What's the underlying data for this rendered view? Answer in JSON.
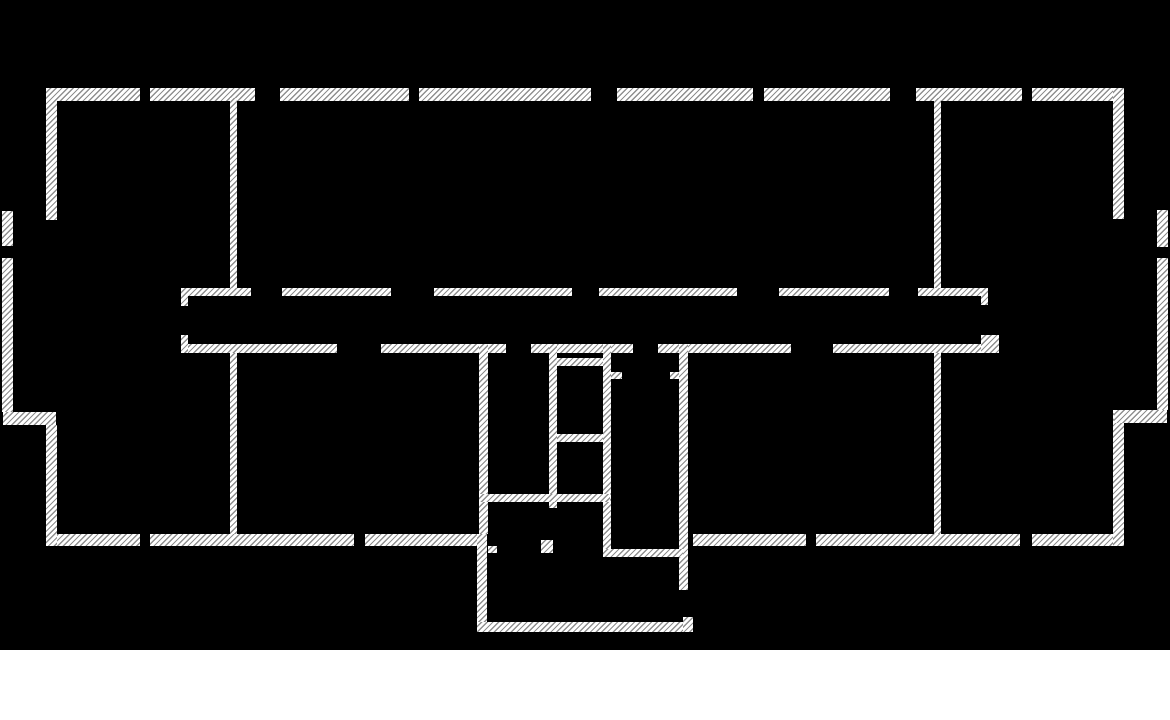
{
  "page": {
    "type": "architectural-floor-plan",
    "canvas_width": 1170,
    "canvas_height": 650,
    "total_height": 720
  },
  "colors": {
    "background": "#000000",
    "page_background": "#ffffff",
    "wall_fill": "#ffffff",
    "hatch_line": "#8f8f8f",
    "hatch_spacing_px": 4,
    "hatch_line_px": 1.3,
    "hatch_direction_deg": 135
  },
  "floor_plan": {
    "walls": [
      {
        "id": "top-wall-segment-1",
        "x": 46,
        "y": 88,
        "w": 94,
        "h": 13
      },
      {
        "id": "top-wall-segment-2",
        "x": 150,
        "y": 88,
        "w": 105,
        "h": 13
      },
      {
        "id": "top-wall-segment-3",
        "x": 280,
        "y": 88,
        "w": 129,
        "h": 13
      },
      {
        "id": "top-wall-segment-4",
        "x": 419,
        "y": 88,
        "w": 172,
        "h": 13
      },
      {
        "id": "top-wall-segment-5",
        "x": 617,
        "y": 88,
        "w": 136,
        "h": 13
      },
      {
        "id": "top-wall-segment-6",
        "x": 764,
        "y": 88,
        "w": 126,
        "h": 13
      },
      {
        "id": "top-wall-segment-7",
        "x": 916,
        "y": 88,
        "w": 106,
        "h": 13
      },
      {
        "id": "top-wall-segment-8",
        "x": 1032,
        "y": 88,
        "w": 92,
        "h": 13
      },
      {
        "id": "bottom-wall-segment-1",
        "x": 48,
        "y": 534,
        "w": 92,
        "h": 12
      },
      {
        "id": "bottom-wall-segment-2",
        "x": 150,
        "y": 534,
        "w": 204,
        "h": 12
      },
      {
        "id": "bottom-wall-segment-3",
        "x": 365,
        "y": 534,
        "w": 117,
        "h": 12
      },
      {
        "id": "bottom-wall-segment-4",
        "x": 693,
        "y": 534,
        "w": 113,
        "h": 12
      },
      {
        "id": "bottom-wall-segment-5",
        "x": 816,
        "y": 534,
        "w": 204,
        "h": 12
      },
      {
        "id": "bottom-wall-segment-6",
        "x": 1032,
        "y": 534,
        "w": 86,
        "h": 12
      },
      {
        "id": "left-wall-upper",
        "x": 46,
        "y": 88,
        "w": 11,
        "h": 132
      },
      {
        "id": "left-wall-lower",
        "x": 46,
        "y": 425,
        "w": 11,
        "h": 121
      },
      {
        "id": "right-wall-upper",
        "x": 1113,
        "y": 88,
        "w": 11,
        "h": 131
      },
      {
        "id": "right-wall-lower",
        "x": 1113,
        "y": 410,
        "w": 11,
        "h": 136
      },
      {
        "id": "left-bay-wall-upper",
        "x": 2,
        "y": 211,
        "w": 11,
        "h": 35
      },
      {
        "id": "left-bay-wall-lower",
        "x": 2,
        "y": 258,
        "w": 11,
        "h": 154
      },
      {
        "id": "left-bay-connector",
        "x": 3,
        "y": 412,
        "w": 53,
        "h": 13
      },
      {
        "id": "right-bay-wall-upper",
        "x": 1157,
        "y": 210,
        "w": 11,
        "h": 37
      },
      {
        "id": "right-bay-wall-lower",
        "x": 1157,
        "y": 258,
        "w": 11,
        "h": 152
      },
      {
        "id": "right-bay-connector",
        "x": 1114,
        "y": 410,
        "w": 53,
        "h": 13
      },
      {
        "id": "left-room-divider-upper",
        "x": 230,
        "y": 98,
        "w": 7,
        "h": 190
      },
      {
        "id": "left-room-divider-lower",
        "x": 230,
        "y": 353,
        "w": 7,
        "h": 181
      },
      {
        "id": "right-room-divider-upper",
        "x": 934,
        "y": 98,
        "w": 7,
        "h": 190
      },
      {
        "id": "right-room-divider-lower",
        "x": 934,
        "y": 353,
        "w": 7,
        "h": 181
      },
      {
        "id": "corridor-upper-wall-segment-1",
        "x": 181,
        "y": 288,
        "w": 70,
        "h": 8
      },
      {
        "id": "corridor-upper-wall-segment-2",
        "x": 282,
        "y": 288,
        "w": 109,
        "h": 8
      },
      {
        "id": "corridor-upper-wall-segment-3",
        "x": 434,
        "y": 288,
        "w": 138,
        "h": 8
      },
      {
        "id": "corridor-upper-wall-segment-4",
        "x": 599,
        "y": 288,
        "w": 138,
        "h": 8
      },
      {
        "id": "corridor-upper-wall-segment-5",
        "x": 779,
        "y": 288,
        "w": 110,
        "h": 8
      },
      {
        "id": "corridor-upper-wall-segment-6",
        "x": 918,
        "y": 288,
        "w": 68,
        "h": 8
      },
      {
        "id": "corridor-upper-west-end-stub",
        "x": 181,
        "y": 288,
        "w": 7,
        "h": 18
      },
      {
        "id": "corridor-upper-east-end-stub",
        "x": 981,
        "y": 288,
        "w": 7,
        "h": 17
      },
      {
        "id": "corridor-lower-wall-segment-1",
        "x": 181,
        "y": 344,
        "w": 156,
        "h": 9
      },
      {
        "id": "corridor-lower-wall-segment-2",
        "x": 381,
        "y": 344,
        "w": 125,
        "h": 9
      },
      {
        "id": "corridor-lower-wall-segment-3",
        "x": 531,
        "y": 344,
        "w": 102,
        "h": 9
      },
      {
        "id": "corridor-lower-wall-segment-4",
        "x": 658,
        "y": 344,
        "w": 133,
        "h": 9
      },
      {
        "id": "corridor-lower-wall-segment-5",
        "x": 833,
        "y": 344,
        "w": 153,
        "h": 9
      },
      {
        "id": "corridor-lower-west-end-stub",
        "x": 181,
        "y": 335,
        "w": 7,
        "h": 18
      },
      {
        "id": "corridor-lower-east-end-stub",
        "x": 981,
        "y": 335,
        "w": 18,
        "h": 18
      },
      {
        "id": "stair-block-west-wall",
        "x": 479,
        "y": 344,
        "w": 9,
        "h": 190
      },
      {
        "id": "stair-block-inner-wall-1",
        "x": 549,
        "y": 344,
        "w": 8,
        "h": 164
      },
      {
        "id": "stair-block-inner-wall-2",
        "x": 603,
        "y": 344,
        "w": 8,
        "h": 213
      },
      {
        "id": "stair-block-east-wall",
        "x": 679,
        "y": 344,
        "w": 9,
        "h": 246
      },
      {
        "id": "stair-landing-wall-upper",
        "x": 557,
        "y": 358,
        "w": 46,
        "h": 8
      },
      {
        "id": "stair-landing-wall-lower",
        "x": 557,
        "y": 434,
        "w": 46,
        "h": 8
      },
      {
        "id": "stair-door-jamb-west",
        "x": 611,
        "y": 372,
        "w": 11,
        "h": 7
      },
      {
        "id": "stair-door-jamb-east",
        "x": 670,
        "y": 372,
        "w": 9,
        "h": 7
      },
      {
        "id": "vestibule-south-wall",
        "x": 479,
        "y": 494,
        "w": 131,
        "h": 8
      },
      {
        "id": "entry-door-jamb-west",
        "x": 488,
        "y": 546,
        "w": 9,
        "h": 7
      },
      {
        "id": "entry-door-jamb-east",
        "x": 541,
        "y": 540,
        "w": 12,
        "h": 13
      },
      {
        "id": "stair-block-south-connector",
        "x": 603,
        "y": 549,
        "w": 80,
        "h": 8
      },
      {
        "id": "porch-west-wall",
        "x": 477,
        "y": 534,
        "w": 10,
        "h": 98
      },
      {
        "id": "porch-south-wall",
        "x": 477,
        "y": 622,
        "w": 216,
        "h": 10
      },
      {
        "id": "porch-east-corner",
        "x": 683,
        "y": 617,
        "w": 10,
        "h": 15
      }
    ]
  }
}
